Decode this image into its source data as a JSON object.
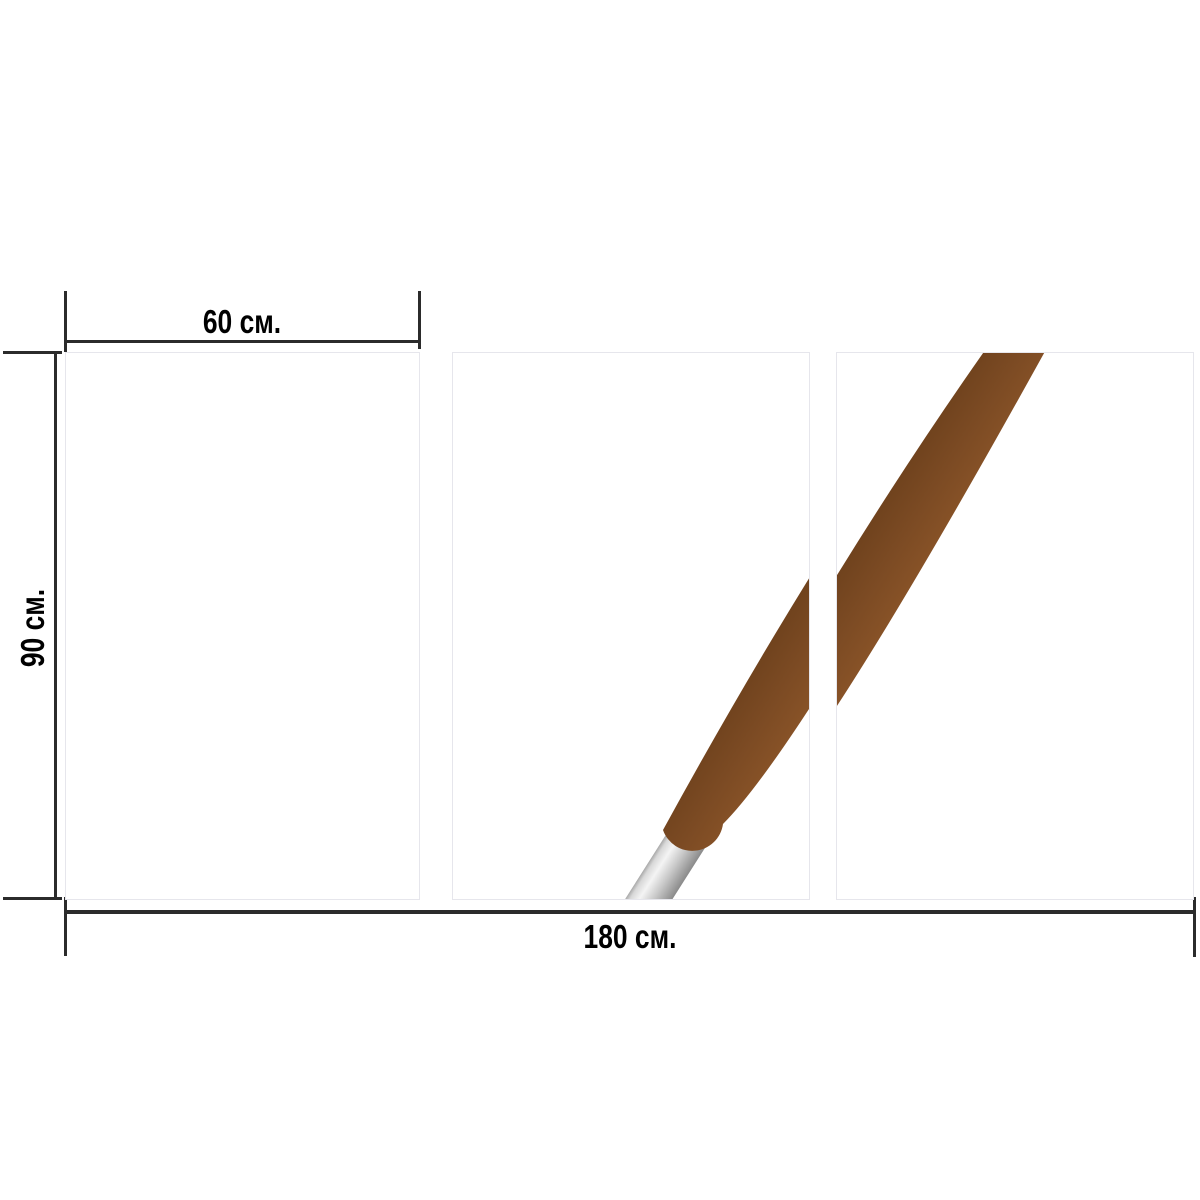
{
  "dimension_labels": {
    "panel_width": "60 см.",
    "panel_height": "90 см.",
    "total_width": "180 см."
  },
  "panels": [
    {
      "name": "left-panel"
    },
    {
      "name": "center-panel"
    },
    {
      "name": "right-panel"
    }
  ],
  "artwork": {
    "subject": "paintbrush-handle"
  },
  "colors": {
    "background": "#ffffff",
    "annotation": "#2b2b2b",
    "panel_border": "#e6e6ec",
    "handle_dark": "#6f421d",
    "handle_mid": "#7b4a23",
    "handle_light": "#875227",
    "ferrule_edge": "#a8a8a8",
    "ferrule_bright": "#f4f4f4",
    "ferrule_mid": "#c9c9c9",
    "ferrule_dark": "#8a8a8a"
  }
}
